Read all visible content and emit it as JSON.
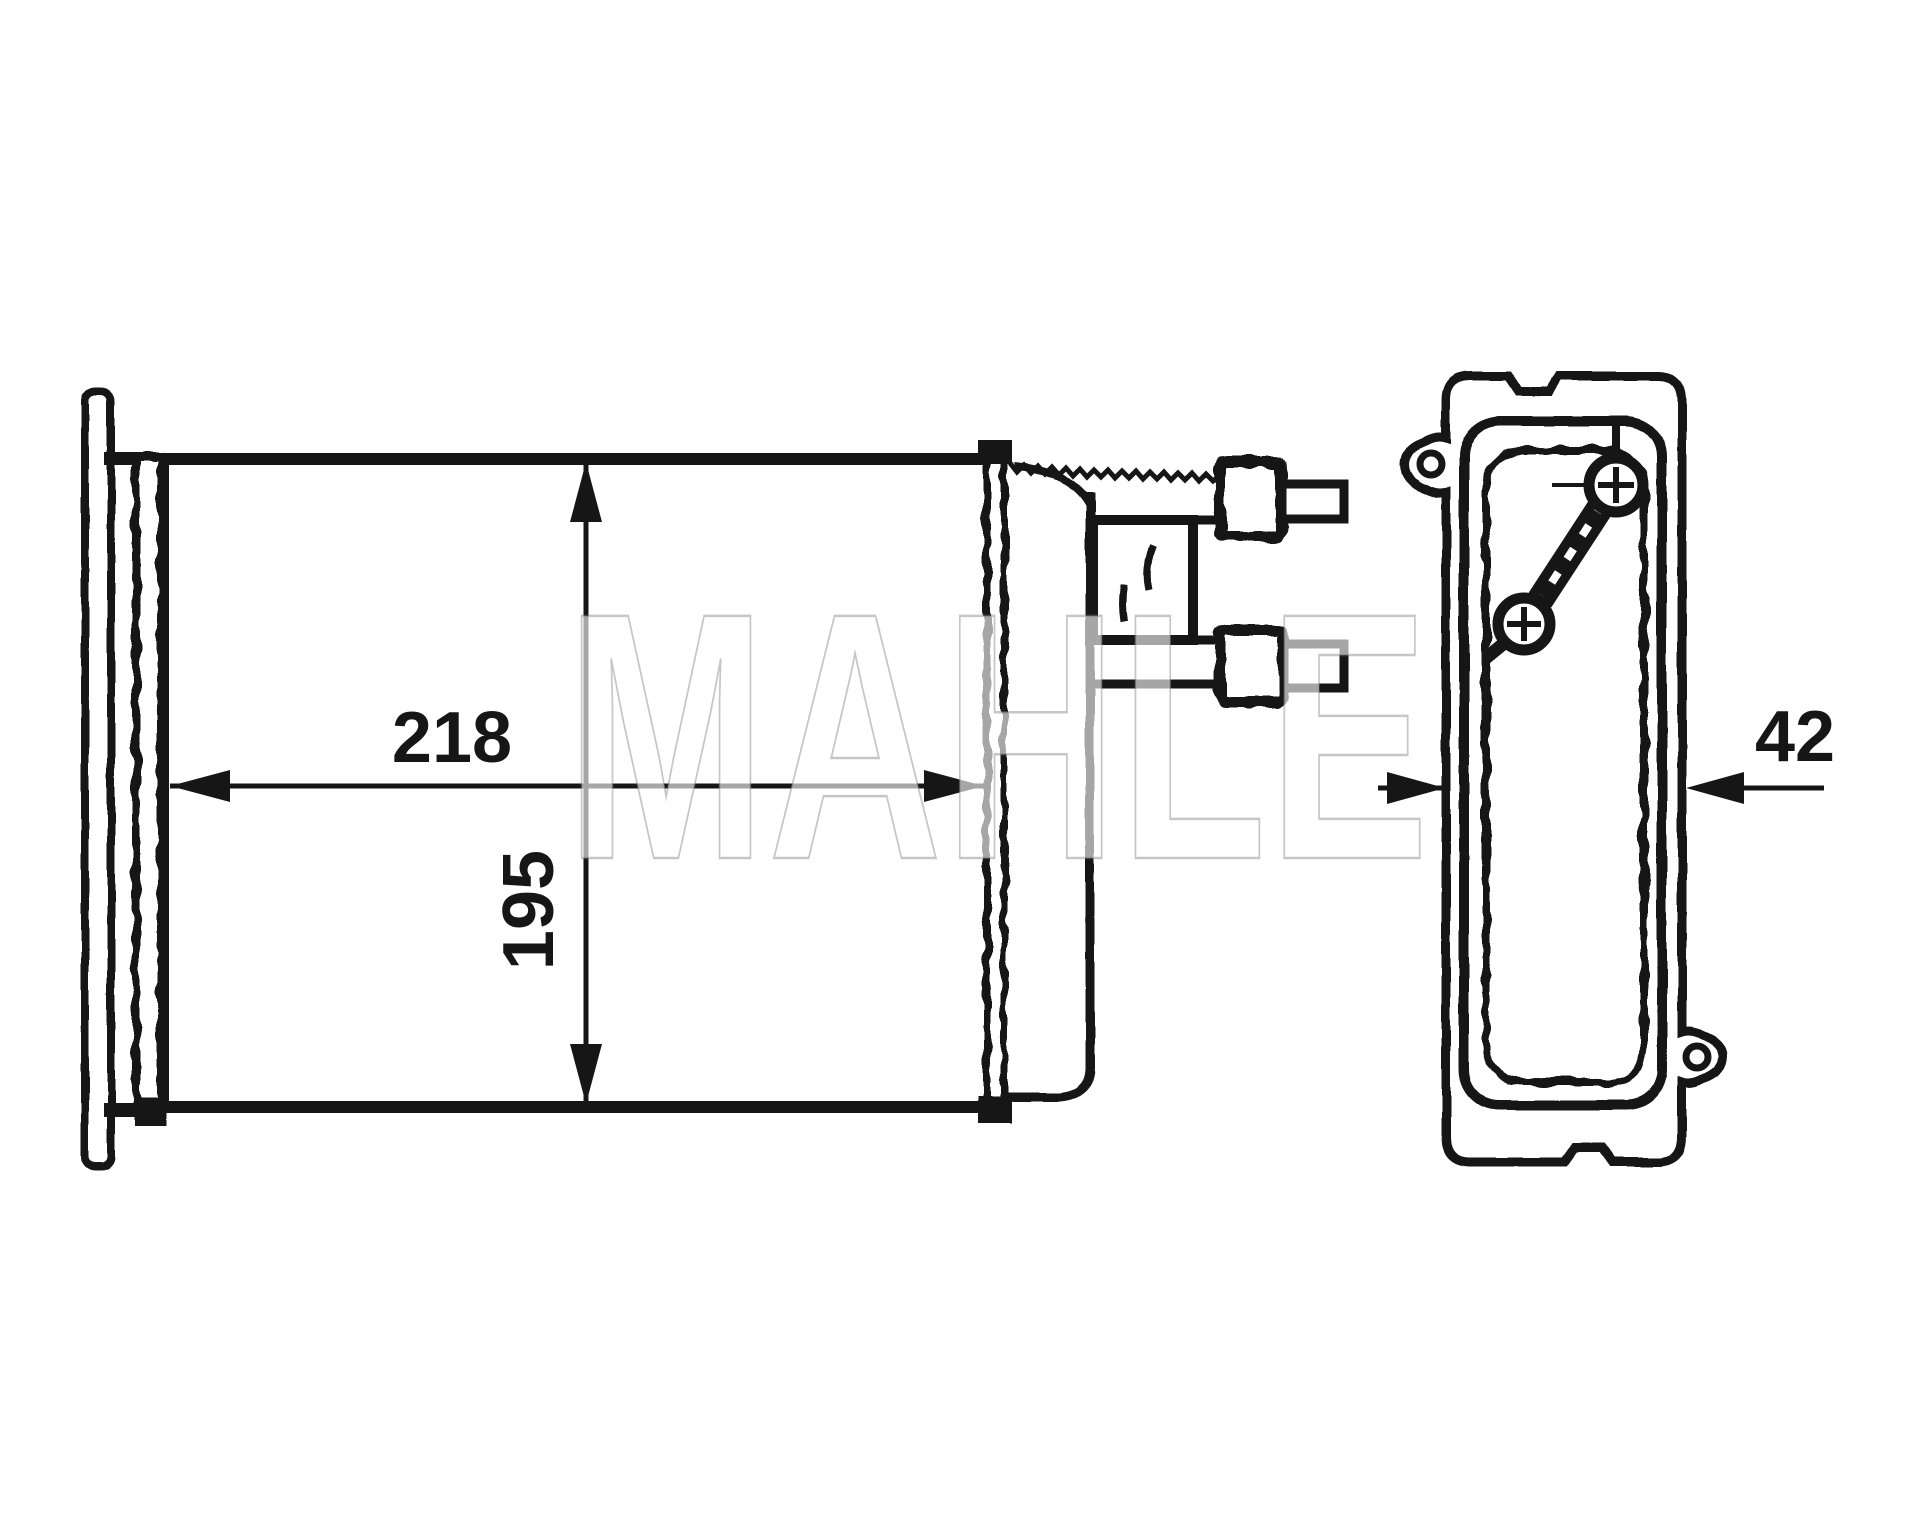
{
  "watermark": "MAHLE",
  "dimensions": {
    "length": "218",
    "height": "195",
    "depth": "42"
  }
}
